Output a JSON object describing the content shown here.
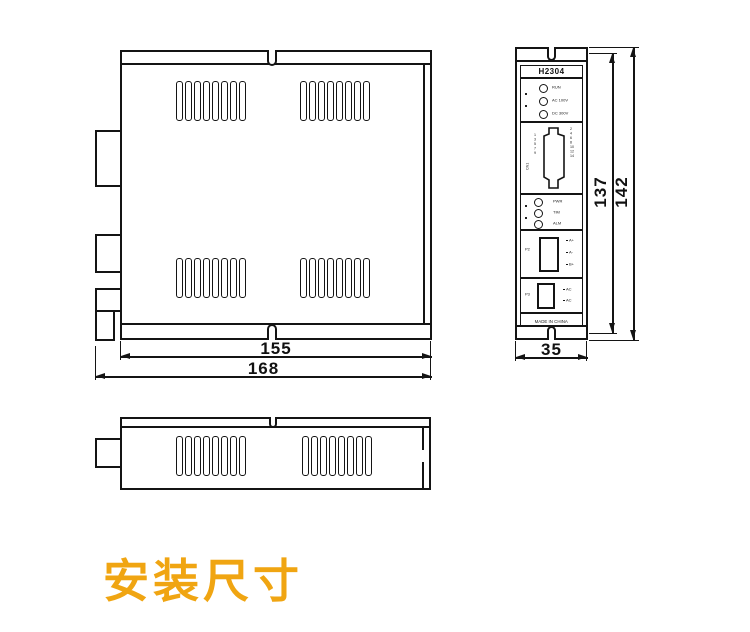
{
  "title": {
    "text": "安装尺寸",
    "color": "#F0A512",
    "meaning": "Installation dimensions"
  },
  "dimensions": {
    "top_view": {
      "inner_width": "155",
      "outer_width": "168"
    },
    "front_view": {
      "width": "35",
      "body_height": "137",
      "total_height": "142"
    }
  },
  "front_panel": {
    "model": "H2304",
    "status_leds": [
      "RUN",
      "AC 100V",
      "DC 300V"
    ],
    "connector_side_label": "CN1",
    "db_pins_left": [
      "1",
      "3",
      "5",
      "7",
      "9"
    ],
    "db_pins_right": [
      "2",
      "4",
      "6",
      "8",
      "10",
      "12",
      "14"
    ],
    "mid_leds": [
      "PWR",
      "TIM",
      "ALM"
    ],
    "terminal1": {
      "label": "P2",
      "pins": [
        "A+",
        "A-",
        "B+"
      ]
    },
    "terminal2": {
      "label": "P3",
      "pins": [
        "AC",
        "AC"
      ]
    },
    "footer": "MADE IN CHINA"
  },
  "vents": {
    "slots_per_group": 8,
    "top_view_groups": 4,
    "side_view_groups": 2
  },
  "line_color": "#141414"
}
